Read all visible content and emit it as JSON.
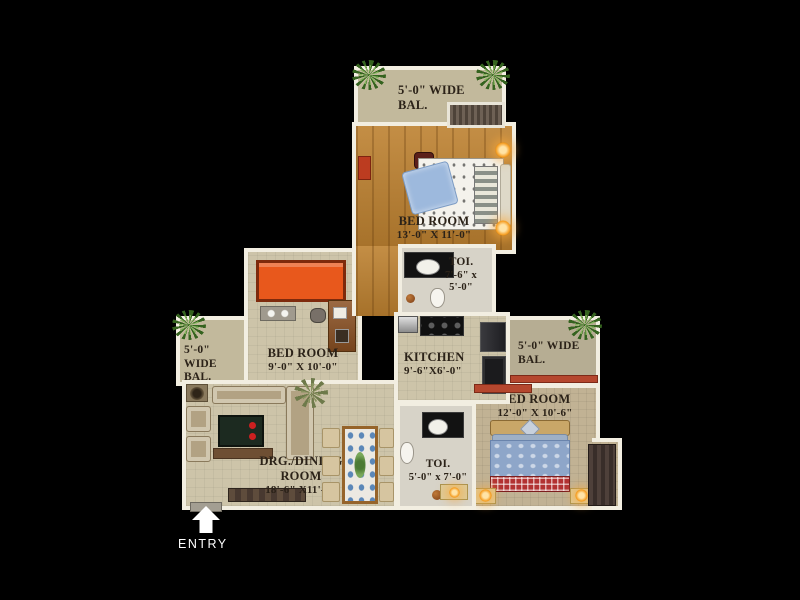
{
  "plan": {
    "entry": {
      "label": "ENTRY"
    },
    "rooms": {
      "balcony_top": {
        "line1": "5'-0\" WIDE",
        "line2": "BAL."
      },
      "bedroom_top": {
        "line1": "BED ROOM",
        "line2": "13'-0\" X 11'-0\""
      },
      "toilet_top": {
        "line1": "TOI.",
        "line2": "7'-6\" x 5'-0\""
      },
      "balcony_left": {
        "line1": "5'-0\" WIDE",
        "line2": "BAL."
      },
      "bedroom_left": {
        "line1": "BED ROOM",
        "line2": "9'-0\" X 10'-0\""
      },
      "kitchen": {
        "line1": "KITCHEN",
        "line2": "9'-6\"X6'-0\""
      },
      "balcony_right": {
        "line1": "5'-0\" WIDE",
        "line2": "BAL."
      },
      "bedroom_right": {
        "line1": "BED ROOM",
        "line2": "12'-0\" X 10'-6\""
      },
      "drg_dining": {
        "line1": "DRG./DINING",
        "line2": "ROOM",
        "line3": "18'-6\" X11'-0\""
      },
      "toilet_bottom": {
        "line1": "TOI.",
        "line2": "5'-0\" x 7'-0\""
      }
    },
    "colors": {
      "background": "#000000",
      "wall": "#f2eee1",
      "floor_wood": "#bd8130",
      "floor_beige": "#cdc4a9",
      "floor_balcony": "#c2b99c",
      "floor_toilet": "#d7d3c8",
      "bed_orange": "#e8581c",
      "red_sill": "#b5472e",
      "label_text": "#2b2218",
      "entry_text": "#ffffff"
    }
  }
}
